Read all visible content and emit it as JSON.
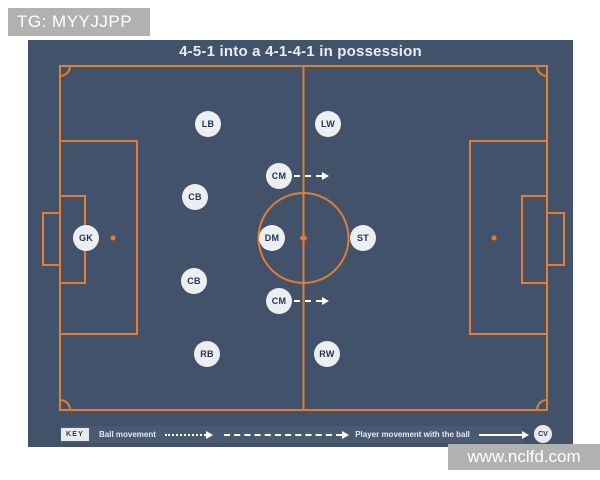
{
  "watermarks": {
    "top": "TG: MYYJJPP",
    "bottom": "www.nclfd.com"
  },
  "diagram": {
    "title": "4-5-1 into a 4-1-4-1 in possession"
  },
  "players": [
    {
      "label": "GK",
      "x": 58,
      "y": 198,
      "arrow": false
    },
    {
      "label": "LB",
      "x": 180,
      "y": 84,
      "arrow": false
    },
    {
      "label": "CB",
      "x": 167,
      "y": 157,
      "arrow": false
    },
    {
      "label": "CB",
      "x": 166,
      "y": 241,
      "arrow": false
    },
    {
      "label": "RB",
      "x": 179,
      "y": 314,
      "arrow": false
    },
    {
      "label": "CM",
      "x": 251,
      "y": 136,
      "arrow": true
    },
    {
      "label": "DM",
      "x": 244,
      "y": 198,
      "arrow": false
    },
    {
      "label": "CM",
      "x": 251,
      "y": 261,
      "arrow": true
    },
    {
      "label": "LW",
      "x": 300,
      "y": 84,
      "arrow": false
    },
    {
      "label": "ST",
      "x": 335,
      "y": 198,
      "arrow": false
    },
    {
      "label": "RW",
      "x": 299,
      "y": 314,
      "arrow": false
    }
  ],
  "key": {
    "label": "KEY",
    "ball_movement": "Ball movement",
    "player_movement": "Player movement with the ball",
    "badge": "CV"
  },
  "colors": {
    "background": "#42526A",
    "line": "#E07F33",
    "player_fill": "#ECEEF1",
    "player_text": "#22374E",
    "key_bar": "#4A5A71",
    "arrow": "#FFFFFF",
    "watermark_bg": "#B1B1B1",
    "title_text": "#E9EDF3"
  }
}
